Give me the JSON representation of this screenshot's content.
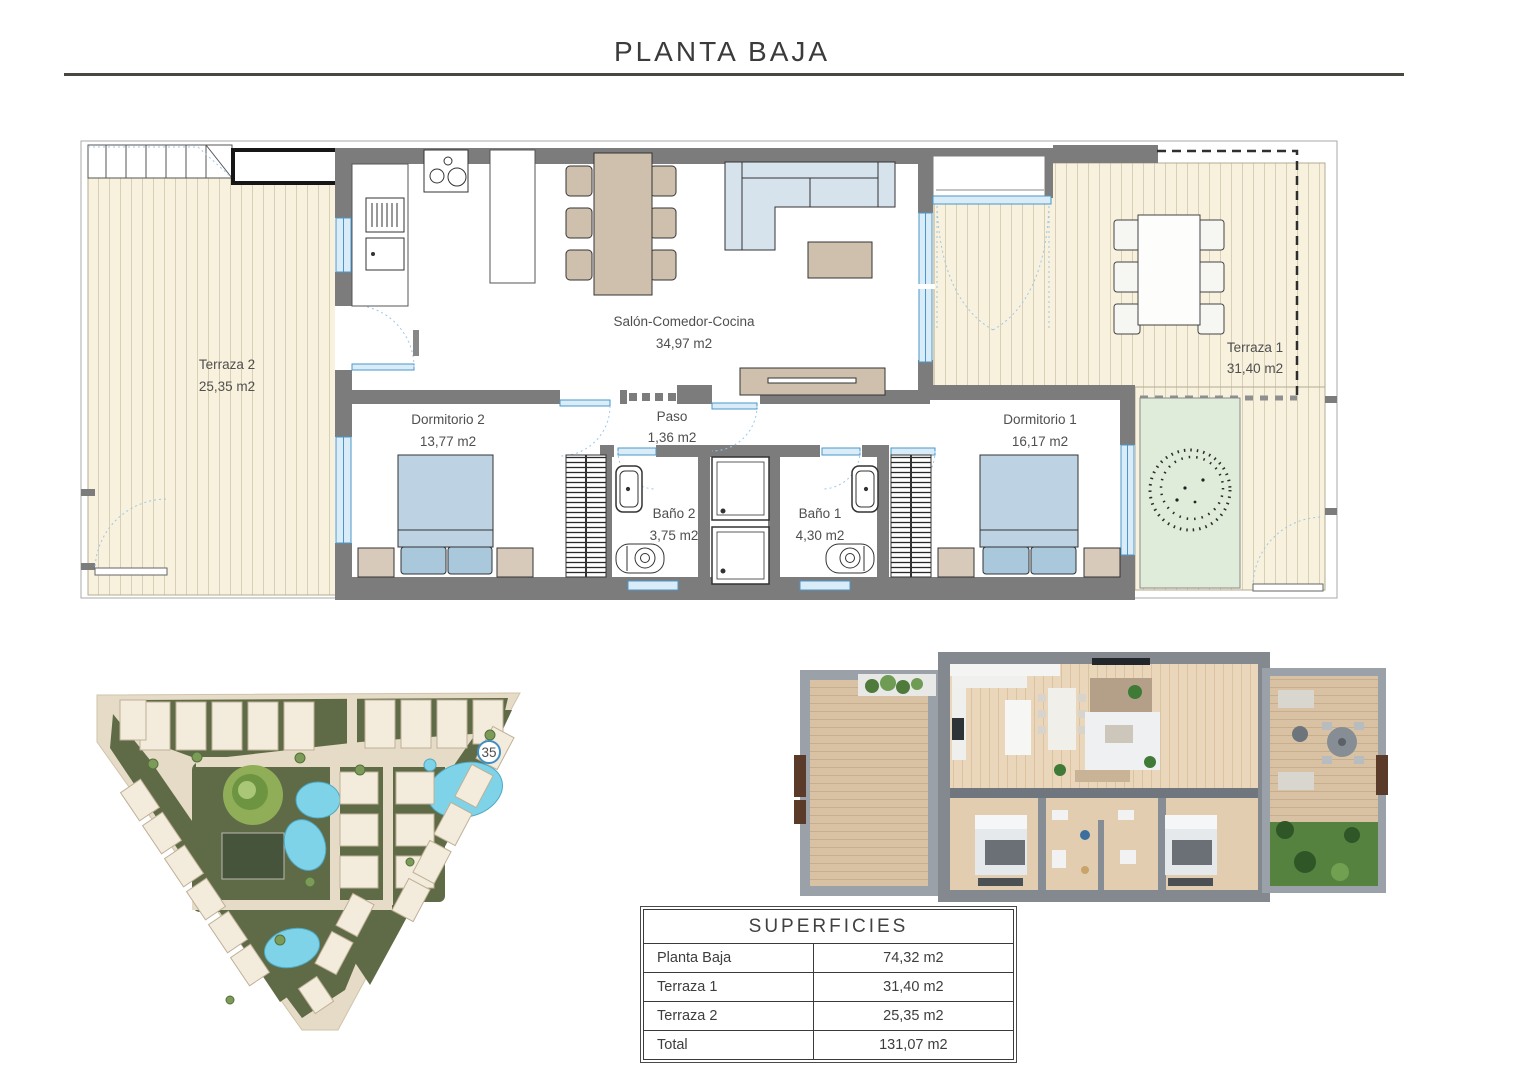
{
  "page": {
    "title": "PLANTA BAJA"
  },
  "floor_plan": {
    "rooms": {
      "terraza2": {
        "name": "Terraza 2",
        "area": "25,35 m2"
      },
      "salon": {
        "name": "Salón-Comedor-Cocina",
        "area": "34,97 m2"
      },
      "terraza1": {
        "name": "Terraza 1",
        "area": "31,40 m2"
      },
      "dormitorio2": {
        "name": "Dormitorio 2",
        "area": "13,77 m2"
      },
      "paso": {
        "name": "Paso",
        "area": "1,36 m2"
      },
      "bano2": {
        "name": "Baño 2",
        "area": "3,75 m2"
      },
      "bano1": {
        "name": "Baño 1",
        "area": "4,30 m2"
      },
      "dormitorio1": {
        "name": "Dormitorio 1",
        "area": "16,17 m2"
      }
    },
    "colors": {
      "wall": "#7c7c7c",
      "deck": "#f7f1dd",
      "deck_stripe": "#d8d0b6",
      "window_blue": "#4a97c9",
      "glazing": "#d9ecf8",
      "furniture_tan": "#cfc0ad",
      "bed_blue": "#bdd3e4",
      "garden_green": "#dfecd9"
    }
  },
  "site_plan": {
    "marker": "35",
    "pool_color": "#7ed3e8",
    "green_color": "#5f6b47"
  },
  "surfaces_table": {
    "title": "SUPERFICIES",
    "rows": [
      {
        "label": "Planta Baja",
        "value": "74,32 m2"
      },
      {
        "label": "Terraza 1",
        "value": "31,40 m2"
      },
      {
        "label": "Terraza 2",
        "value": "25,35 m2"
      },
      {
        "label": "Total",
        "value": "131,07 m2"
      }
    ]
  }
}
